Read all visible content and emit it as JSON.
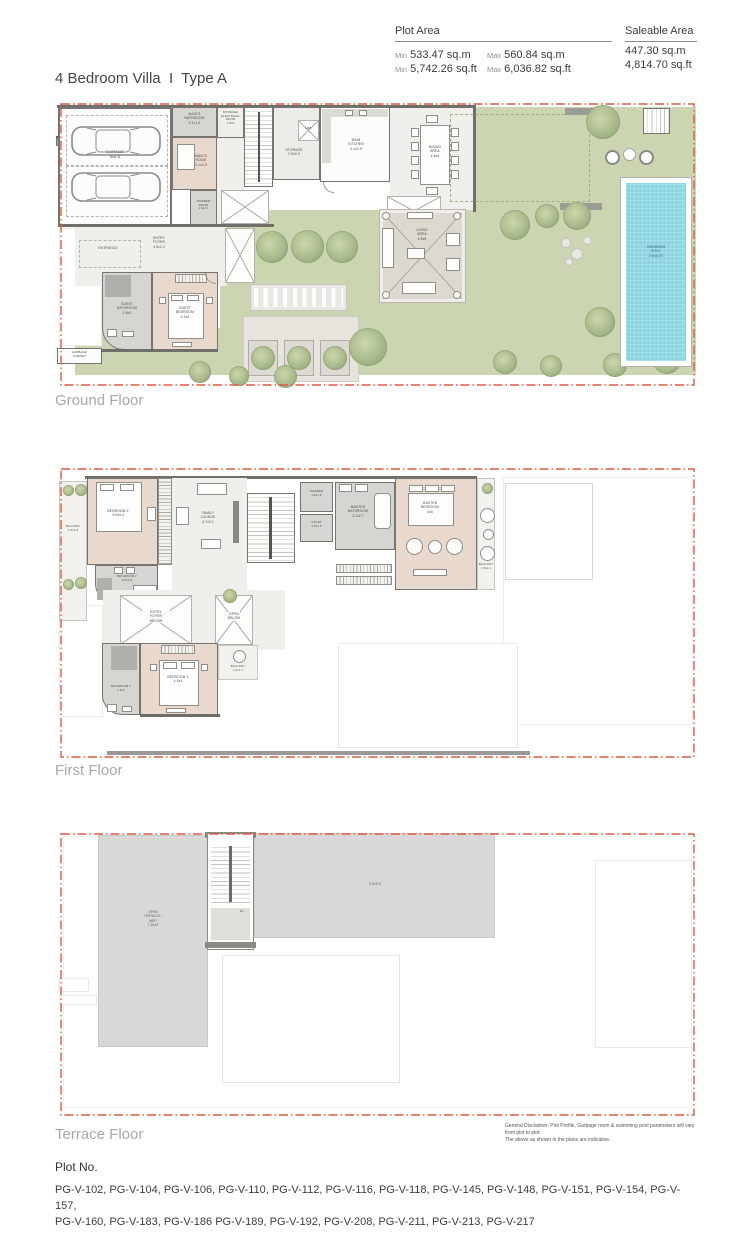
{
  "colors": {
    "accent_red": "#dd5a41",
    "garden_green": "#ccd5b2",
    "pool_blue": "#8ad3e1",
    "bedroom_pink": "#e9d8cc",
    "wall_gray": "#6f6e68"
  },
  "header": {
    "title_line1": "4 Bedroom Villa  I  Type A",
    "title_line2": "Mirror",
    "plot_area": {
      "label": "Plot Area",
      "min_label": "Min",
      "max_label": "Max",
      "min_sqm": "533.47 sq.m",
      "max_sqm": "560.84 sq.m",
      "min_sqft": "5,742.26 sq.ft",
      "max_sqft": "6,036.82 sq.ft"
    },
    "saleable_area": {
      "label": "Saleable Area",
      "sqm": "447.30 sq.m",
      "sqft": "4,814.70 sq.ft"
    }
  },
  "ground": {
    "label": "Ground Floor",
    "rooms": {
      "garage": "GARAGE\n6x6.5",
      "maids_bathroom": "MAID'S\nBATHROOM\n2.1x1.6",
      "maids_room": "MAID'S\nROOM\n3.1x2.9",
      "powder_room": "POWDER\nROOM\n1.9x2.1",
      "storage_electrical": "STORAGE/\nELECTRICAL\nROOM\n1.9x2",
      "storage": "STORAGE\n2.9x2.9",
      "lift": "LIFT",
      "kitchen": "MAIN\nKITCHEN\n3.1x2.9",
      "dining": "DINING\nAREA\n4.5x4",
      "living": "LIVING\nAREA\n4.5x5",
      "entrance": "ENTRANCE",
      "entry_foyer": "ENTRY\nFOYER\n4.5x2.2",
      "guest_bedroom": "GUEST\nBEDROOM\n4.3x4",
      "guest_bathroom": "GUEST\nBATHROOM\n1.6x3",
      "garbage": "GARBAGE\nCABINET",
      "pool": "SWIMMING\nPOOL\n3.5x10.5"
    }
  },
  "first": {
    "label": "First Floor",
    "rooms": {
      "balcony_left": "BALCONY\n1.5x4.8",
      "bedroom2": "BEDROOM 2\n3.6x4.4",
      "bathroom2": "BATHROOM 2\n3.6x1.8",
      "family_lounge": "FAMILY\nLOUNGE\n3.7x3.1",
      "shower": "SHOWER\n1.8x1.6",
      "toilet": "TOILET\n1.8x1.6",
      "master_bathroom": "MASTER\nBATHROOM\n3.1x2.7",
      "master_bedroom": "MASTER\nBEDROOM\n4x5",
      "balcony_right": "BALCONY\n1.5x2.1",
      "entry_foyer_below": "ENTRY\nFOYER\nBELOW",
      "open_below": "OPEN\nBELOW",
      "bedroom1": "BEDROOM 1\n4.3x4",
      "bathroom1": "BATHROOM 1\n1.6x3",
      "balcony_bottom": "BALCONY\n1.5x1.7"
    }
  },
  "terrace": {
    "label": "Terrace Floor",
    "rooms": {
      "open_terrace": "OPEN\nTERRACE /\nMEP\n7.3x10",
      "roof_dim": "9.6x5.5",
      "dn": "Dn"
    }
  },
  "disclaimer": {
    "line1": "General Disclaimer: Plot Profile, Garbage room & swimming pool parameters will vary from plot to plot.",
    "line2": "The above as shown in the plans are indicative."
  },
  "footer": {
    "plot_no_label": "Plot No.",
    "plots_line1": "PG-V-102, PG-V-104, PG-V-106, PG-V-110, PG-V-112, PG-V-116, PG-V-118, PG-V-145, PG-V-148, PG-V-151, PG-V-154, PG-V-157,",
    "plots_line2": "PG-V-160, PG-V-183, PG-V-186 PG-V-189, PG-V-192, PG-V-208, PG-V-211, PG-V-213, PG-V-217"
  }
}
